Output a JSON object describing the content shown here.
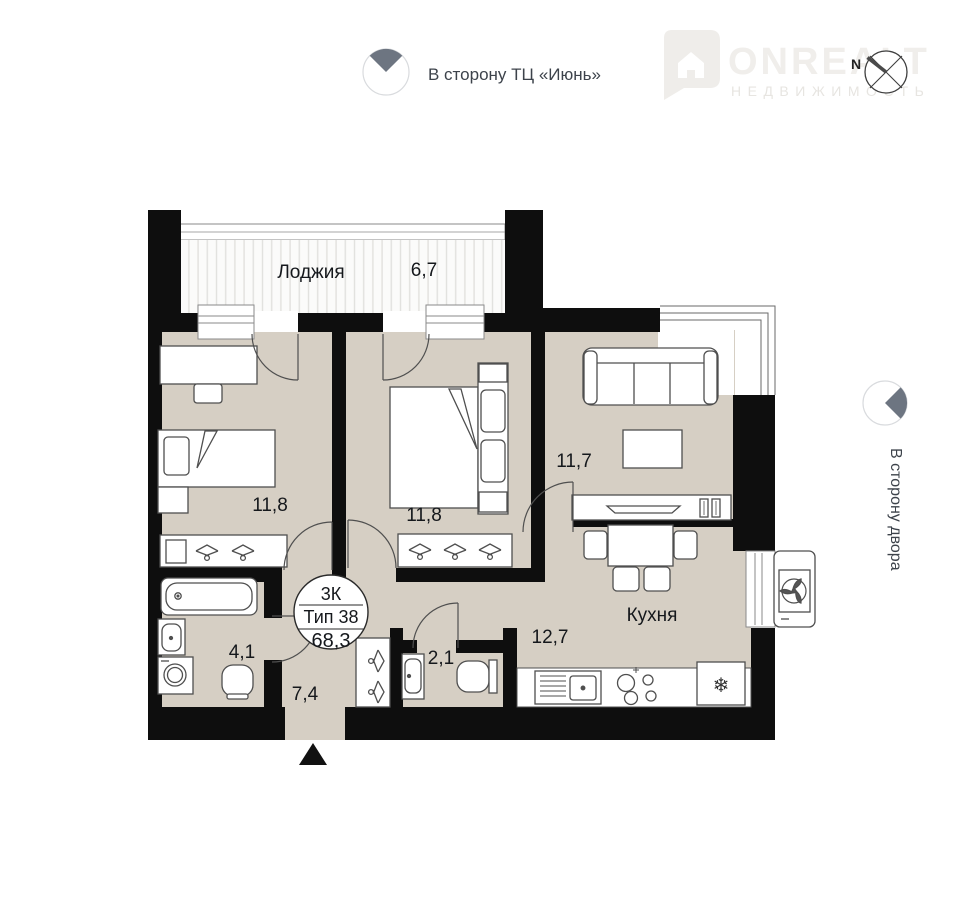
{
  "indicators": {
    "top": {
      "label": "В сторону ТЦ «Июнь»"
    },
    "side": {
      "label": "В сторону двора"
    },
    "compass": {
      "north_label": "N"
    }
  },
  "watermark": {
    "brand": "ONREALT",
    "subtitle": "НЕДВИЖИМОСТЬ"
  },
  "plan": {
    "summary": {
      "rooms": "3К",
      "type": "Тип 38",
      "total_area": "68,3"
    },
    "rooms": {
      "loggia": {
        "name": "Лоджия",
        "area": "6,7"
      },
      "bedroom_left": {
        "area": "11,8"
      },
      "bedroom_middle": {
        "area": "11,8"
      },
      "living_room": {
        "area": "11,7"
      },
      "kitchen": {
        "name": "Кухня",
        "area": "12,7"
      },
      "bathroom": {
        "area": "4,1"
      },
      "hallway": {
        "area": "7,4"
      },
      "wc": {
        "area": "2,1"
      }
    },
    "colors": {
      "floor": "#d6cfc4",
      "wall": "#0e0e0e",
      "furniture_stroke": "#4f4f4f",
      "indicator": "#6d7581",
      "text": "#15181c"
    },
    "icons": {
      "snowflake": "❄"
    }
  }
}
